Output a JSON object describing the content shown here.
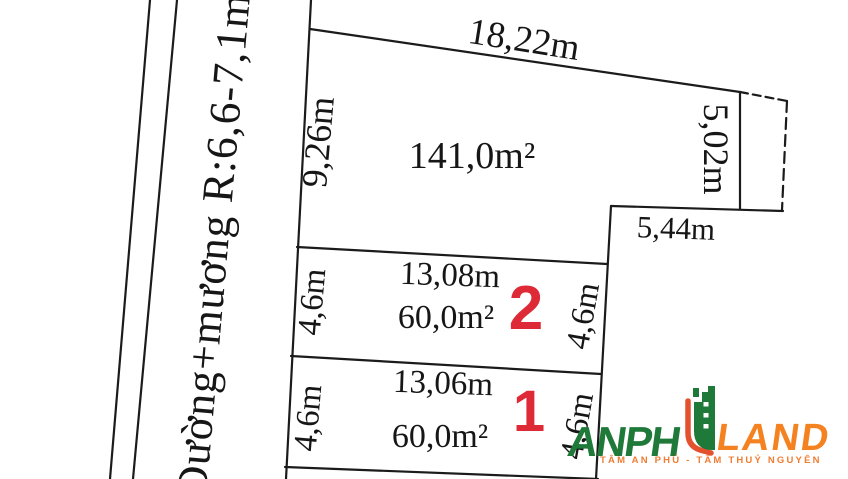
{
  "diagram": {
    "road": {
      "label": "Đường+mương R:6,6-7,1m"
    },
    "main_plot": {
      "area": "141,0m²",
      "top_width": "18,22m",
      "left_height": "9,26m",
      "right_height": "5,02m",
      "bottom_step_width": "5,44m"
    },
    "sub_plots": [
      {
        "number": "2",
        "width": "13,08m",
        "area": "60,0m²",
        "left_height": "4,6m",
        "right_height": "4,6m"
      },
      {
        "number": "1",
        "width": "13,06m",
        "area": "60,0m²",
        "left_height": "4,6m",
        "right_height": "4,6m"
      }
    ]
  },
  "logo": {
    "name_left": "ANPH",
    "name_right": "LAND",
    "tagline": "TÂM AN PHÚ - TÂM THUỶ NGUYÊN"
  },
  "colors": {
    "background": "#ffffff",
    "ink": "#1b1b1b",
    "plot_number_red": "#de2936",
    "logo_green": "#1f7a3a",
    "logo_orange": "#f58220",
    "logo_accent_red": "#e4512e",
    "tagline_orange": "#ef7d33"
  }
}
